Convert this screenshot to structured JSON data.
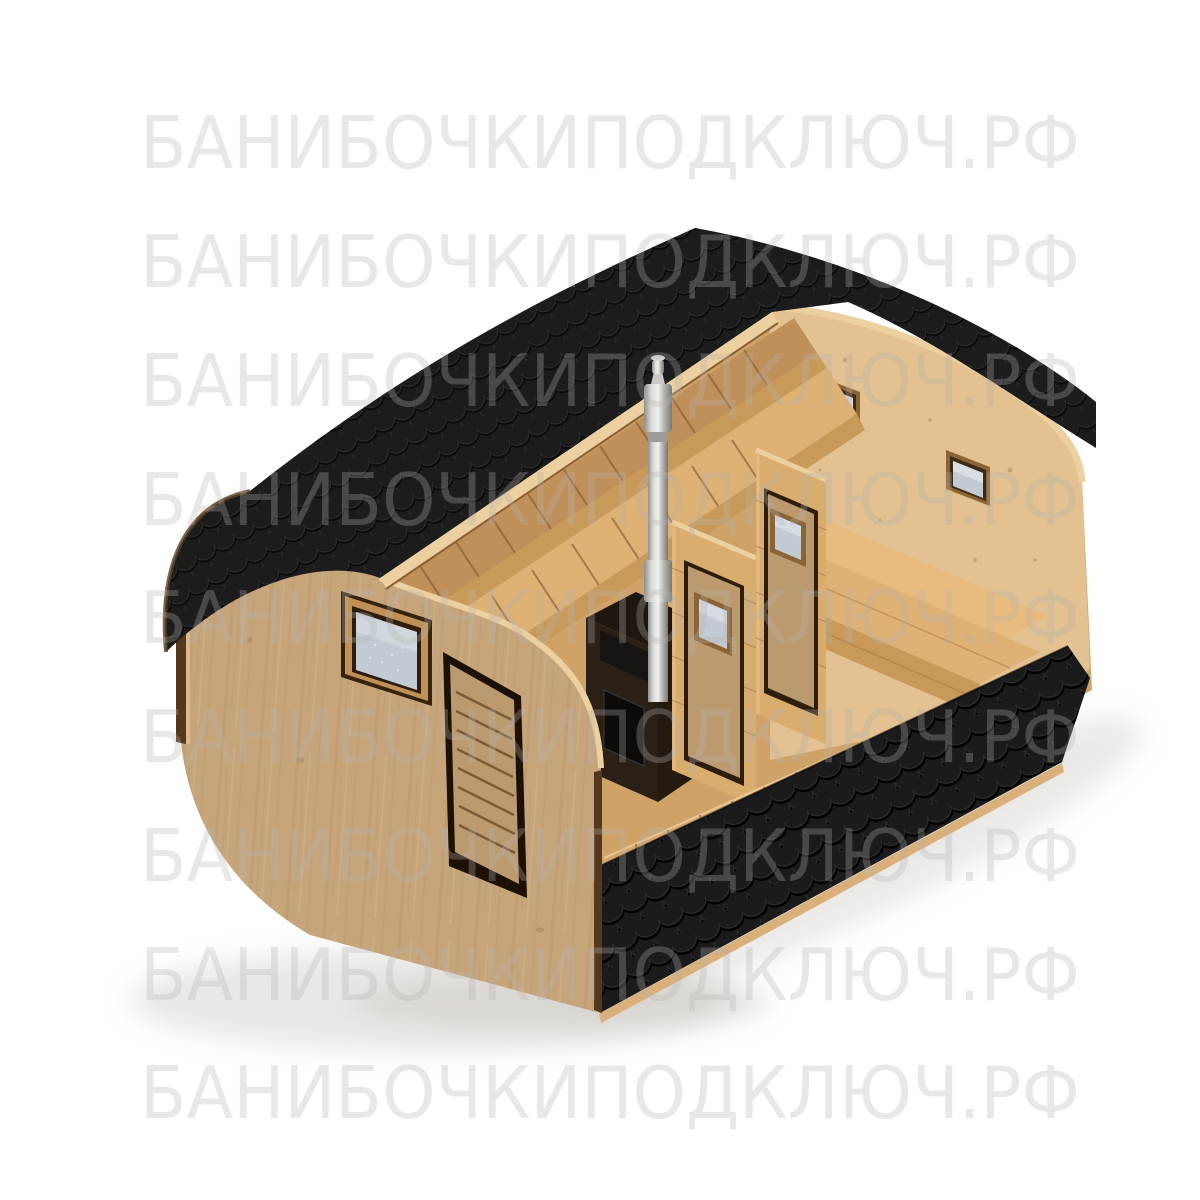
{
  "scene": {
    "description": "3D product render: quadro barrel sauna with black shingle roof, cutaway showing interior with stove, chimney, benches and partition doors",
    "subject": "quadro-barrel-sauna-cutaway"
  },
  "watermark": {
    "text": "БАНИБОЧКИПОДКЛЮЧ.РФ",
    "rows": 9,
    "baselines": [
      168,
      287,
      406,
      525,
      643,
      762,
      881,
      1000,
      1118
    ],
    "x": 140,
    "text_length": 940,
    "font_size": 72,
    "color": "#b5b3b0",
    "opacity": 0.3
  },
  "colors": {
    "background": "#ffffff",
    "shadow": "#d9d5d0",
    "roof": "#1c1c1c",
    "skirt": "#1b1b1b",
    "plywood_edge": "#ecd0a0",
    "wall_wood": "#c7a57b",
    "interior_wood": "#e3c190",
    "inner_band": "#c0905a",
    "floor_wood": "#cfa267",
    "walkway_wood": "#d6a76a",
    "bench_wood": "#deb174",
    "bench_light": "#e8bc7e",
    "fascia_wood": "#c89a5a",
    "partition_wood": "#d9ad6e",
    "door_leaf": "#bb9a6f",
    "trim_dark": "#54381d",
    "stove_body": "#2a2016",
    "stove_door": "#0d0a07",
    "glass": "#c2cbd3",
    "glass_light": "#dde3e8"
  }
}
